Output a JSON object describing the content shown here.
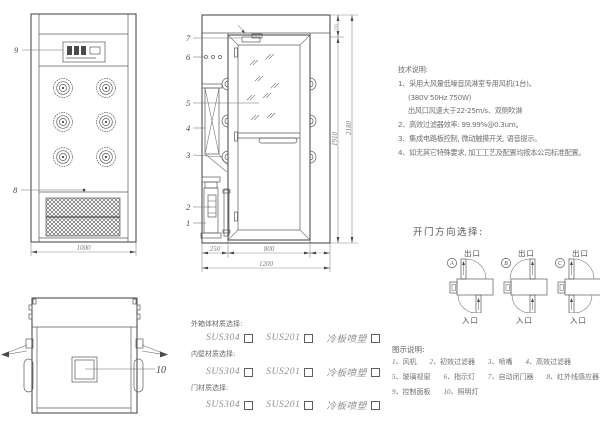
{
  "colors": {
    "line": "#3f3f3f",
    "text": "#6e6e6e",
    "dim": "#7d7d7d",
    "bg": "#ffffff"
  },
  "tech_notes": {
    "title": "技术说明:",
    "lines": [
      "1、采用大风量低噪音风淋室专用风机(1台)。",
      "(380V 50Hz  750W)",
      "出风口风速大于22-25m/s、双侧吹淋",
      "2、高效过滤器效率: 99.99%@0.3um。",
      "3、集成电路板控制, 微动触摸开关, 语音提示。",
      "4、如无其它特殊要求, 加工工艺及配置均按本公司标准配置。"
    ]
  },
  "door_direction": {
    "title": "开门方向选择:",
    "options": [
      {
        "letter": "A",
        "exit": "出口",
        "entry": "入口"
      },
      {
        "letter": "B",
        "exit": "出口",
        "entry": "入口"
      },
      {
        "letter": "C",
        "exit": "出口",
        "entry": "入口"
      }
    ]
  },
  "materials": {
    "sections": [
      {
        "title": "外箱体材质选择:",
        "options": [
          "SUS304",
          "SUS201",
          "冷板喷塑"
        ]
      },
      {
        "title": "内壁材质选择:",
        "options": [
          "SUS304",
          "SUS201",
          "冷板喷塑"
        ]
      },
      {
        "title": "门材质选择:",
        "options": [
          "SUS304",
          "SUS201",
          "冷板喷塑"
        ]
      }
    ]
  },
  "legend": {
    "title": "图示说明:",
    "items": [
      {
        "num": "1、",
        "label": "风机"
      },
      {
        "num": "2、",
        "label": "初效过滤器"
      },
      {
        "num": "3、",
        "label": "喷嘴"
      },
      {
        "num": "4、",
        "label": "高效过滤器"
      },
      {
        "num": "5、",
        "label": "玻璃视窗"
      },
      {
        "num": "6、",
        "label": "指示灯"
      },
      {
        "num": "7、",
        "label": "自动闭门器"
      },
      {
        "num": "8、",
        "label": "红外线感应器"
      },
      {
        "num": "9、",
        "label": "控制面板"
      },
      {
        "num": "10、",
        "label": "照明灯"
      }
    ]
  },
  "dimensions": {
    "front_width": "1000",
    "vestibule_width": "250",
    "door_width": "800",
    "total_width": "1200",
    "door_height": "1910",
    "total_height": "2180",
    "top_section": "270"
  },
  "parts": {
    "p1": "1",
    "p2": "2",
    "p3": "3",
    "p4": "4",
    "p5": "5",
    "p6": "6",
    "p7": "7",
    "p8": "8",
    "p9": "9",
    "p10": "10"
  }
}
